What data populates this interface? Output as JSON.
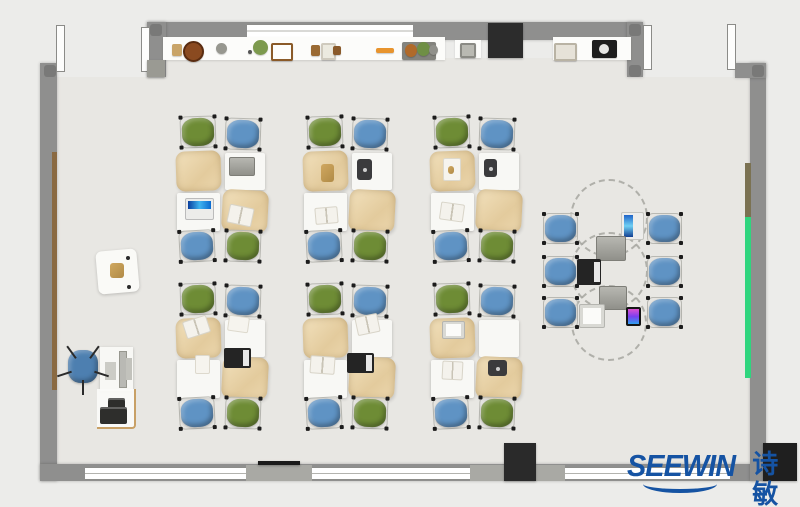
{
  "title": "classroom furniture floor plan",
  "logo": {
    "brand": "SEEWIN",
    "cjk": "诗敏",
    "color": "#1553a3"
  },
  "palette": {
    "outside": "#ececea",
    "floor": "#e8e7e3",
    "wall": "#8f8f8e",
    "wall_light": "#a9a9a4",
    "post": "#797978",
    "window": "#ffffff",
    "chair_green": "#6e8c35",
    "chair_blue": "#5f93c4",
    "chair_office": "#4d7fb0",
    "desk_white": "#f8f8f5",
    "accent_green": "#2fd57e",
    "accent_brown": "#8a6a42",
    "accent_olive": "#7b7252",
    "black": "#232323",
    "dash": "#9e9e98"
  },
  "scene": {
    "w": 800,
    "h": 507,
    "floor": [
      {
        "x": 57,
        "y": 77,
        "w": 693,
        "h": 388
      },
      {
        "x": 166,
        "y": 58,
        "w": 471,
        "h": 20
      }
    ],
    "walls": [
      {
        "x": 40,
        "y": 63,
        "w": 17,
        "h": 418,
        "n": "wall-left"
      },
      {
        "x": 40,
        "y": 464,
        "w": 727,
        "h": 17,
        "n": "wall-bottom"
      },
      {
        "x": 750,
        "y": 63,
        "w": 16,
        "h": 418,
        "n": "wall-right"
      },
      {
        "x": 735,
        "y": 63,
        "w": 31,
        "h": 15,
        "n": "wall-corner-top-right"
      },
      {
        "x": 147,
        "y": 22,
        "w": 496,
        "h": 18,
        "n": "wall-top"
      },
      {
        "x": 147,
        "y": 22,
        "w": 19,
        "h": 55,
        "n": "wall-stub-left"
      },
      {
        "x": 627,
        "y": 22,
        "w": 16,
        "h": 55,
        "n": "wall-stub-right"
      }
    ],
    "piers": [
      {
        "x": 246,
        "y": 465,
        "w": 66,
        "h": 16
      },
      {
        "x": 470,
        "y": 465,
        "w": 95,
        "h": 16
      }
    ],
    "windows": [
      {
        "x": 247,
        "y": 24,
        "w": 166,
        "h": 12
      },
      {
        "x": 85,
        "y": 467,
        "w": 161,
        "h": 11
      },
      {
        "x": 312,
        "y": 467,
        "w": 158,
        "h": 11
      },
      {
        "x": 565,
        "y": 467,
        "w": 165,
        "h": 11
      }
    ],
    "doors": [
      {
        "x": 56,
        "y": 25,
        "w": 7,
        "h": 45
      },
      {
        "x": 141,
        "y": 27,
        "w": 7,
        "h": 43
      },
      {
        "x": 643,
        "y": 25,
        "w": 7,
        "h": 43
      },
      {
        "x": 727,
        "y": 24,
        "w": 7,
        "h": 44
      }
    ],
    "posts": [
      {
        "x": 44,
        "y": 65
      },
      {
        "x": 150,
        "y": 65
      },
      {
        "x": 150,
        "y": 24
      },
      {
        "x": 629,
        "y": 24
      },
      {
        "x": 629,
        "y": 65
      },
      {
        "x": 752,
        "y": 65
      }
    ],
    "accents": [
      {
        "x": 52,
        "y": 152,
        "w": 5,
        "h": 238,
        "c": "#8a6a42",
        "n": "wall-rail-wood"
      },
      {
        "x": 745,
        "y": 163,
        "w": 6,
        "h": 54,
        "c": "#7b7252",
        "n": "wall-panel-olive"
      },
      {
        "x": 745,
        "y": 217,
        "w": 6,
        "h": 161,
        "c": "#2fd57e",
        "n": "wall-board-green"
      }
    ],
    "shelves": [
      {
        "x": 163,
        "y": 37,
        "w": 282,
        "h": 23
      },
      {
        "x": 455,
        "y": 40,
        "w": 26,
        "h": 18
      },
      {
        "x": 553,
        "y": 37,
        "w": 78,
        "h": 23
      }
    ],
    "blocks": [
      {
        "x": 488,
        "y": 23,
        "w": 35,
        "h": 35,
        "c": "#2c2c2c",
        "n": "cabinet"
      },
      {
        "x": 504,
        "y": 443,
        "w": 32,
        "h": 38,
        "c": "#2a2a2a",
        "n": "column"
      },
      {
        "x": 763,
        "y": 443,
        "w": 34,
        "h": 38,
        "c": "#1f1f1f",
        "n": "column"
      },
      {
        "x": 258,
        "y": 461,
        "w": 42,
        "h": 4,
        "c": "#1a1a1a",
        "n": "wall-board"
      },
      {
        "x": 147,
        "y": 60,
        "w": 18,
        "h": 17,
        "c": "#9a9a93",
        "n": "bin"
      }
    ],
    "shelf_items": [
      {
        "x": 172,
        "y": 44,
        "w": 10,
        "h": 12,
        "s": "rect",
        "c": "#c9a468",
        "n": "box"
      },
      {
        "x": 183,
        "y": 41,
        "w": 17,
        "h": 17,
        "s": "circle",
        "c": "#8a4a20",
        "b": "#5a2c10",
        "n": "pot"
      },
      {
        "x": 216,
        "y": 43,
        "w": 11,
        "h": 11,
        "s": "circle",
        "c": "#97978f",
        "n": "sphere"
      },
      {
        "x": 253,
        "y": 40,
        "w": 15,
        "h": 15,
        "s": "circle",
        "c": "#7d9a4e",
        "n": "plant"
      },
      {
        "x": 248,
        "y": 50,
        "w": 4,
        "h": 4,
        "s": "circle",
        "c": "#555555",
        "n": "dot"
      },
      {
        "x": 271,
        "y": 43,
        "w": 18,
        "h": 14,
        "s": "rect",
        "c": "#fdfdfb",
        "b": "#8a5a28",
        "n": "photo-frame"
      },
      {
        "x": 311,
        "y": 45,
        "w": 9,
        "h": 11,
        "s": "rect",
        "c": "#9a6a33",
        "n": "box"
      },
      {
        "x": 321,
        "y": 43,
        "w": 11,
        "h": 13,
        "s": "rect",
        "c": "#eceadf",
        "b": "#cfcabd",
        "n": "vase"
      },
      {
        "x": 333,
        "y": 46,
        "w": 8,
        "h": 9,
        "s": "rect",
        "c": "#8a5a2a",
        "n": "box"
      },
      {
        "x": 376,
        "y": 48,
        "w": 18,
        "h": 5,
        "s": "rect",
        "c": "#e8942d",
        "n": "pencil"
      },
      {
        "x": 402,
        "y": 42,
        "w": 34,
        "h": 18,
        "s": "rect",
        "c": "#83837d",
        "n": "tray"
      },
      {
        "x": 405,
        "y": 44,
        "w": 12,
        "h": 13,
        "s": "circle",
        "c": "#b06a2a",
        "n": "pot"
      },
      {
        "x": 417,
        "y": 42,
        "w": 13,
        "h": 14,
        "s": "circle",
        "c": "#6f8f45",
        "n": "plant"
      },
      {
        "x": 429,
        "y": 45,
        "w": 9,
        "h": 10,
        "s": "circle",
        "c": "#90908a",
        "n": "pot"
      },
      {
        "x": 460,
        "y": 43,
        "w": 12,
        "h": 11,
        "s": "rect",
        "c": "#b9b9b2",
        "b": "#8a8a84",
        "n": "box"
      },
      {
        "x": 554,
        "y": 43,
        "w": 19,
        "h": 14,
        "s": "rect",
        "c": "#e6e2d8",
        "b": "#b9b3a4",
        "n": "photo-frame"
      },
      {
        "x": 592,
        "y": 40,
        "w": 25,
        "h": 18,
        "s": "rect",
        "c": "#1e1e1e",
        "n": "speaker"
      },
      {
        "x": 599,
        "y": 44,
        "w": 10,
        "h": 10,
        "s": "circle",
        "c": "#e6e6e4",
        "n": "speaker-cone"
      }
    ],
    "clusters": {
      "origins": [
        {
          "x": 176,
          "y": 116
        },
        {
          "x": 303,
          "y": 116
        },
        {
          "x": 430,
          "y": 116
        },
        {
          "x": 176,
          "y": 283
        },
        {
          "x": 303,
          "y": 283
        },
        {
          "x": 430,
          "y": 283
        }
      ],
      "chair_w": 36,
      "chair_h": 32,
      "chairs": [
        {
          "dx": 4,
          "dy": 0,
          "color": "green",
          "rot": -2
        },
        {
          "dx": 49,
          "dy": 2,
          "color": "blue",
          "rot": 2
        },
        {
          "dx": 3,
          "dy": 114,
          "color": "blue",
          "rot": -3
        },
        {
          "dx": 49,
          "dy": 114,
          "color": "green",
          "rot": 2
        }
      ],
      "desks": [
        {
          "dx": 0,
          "dy": 35,
          "w": 45,
          "h": 40,
          "type": "tan",
          "rot": -2
        },
        {
          "dx": 49,
          "dy": 37,
          "w": 40,
          "h": 37,
          "type": "white",
          "rot": 0
        },
        {
          "dx": 1,
          "dy": 77,
          "w": 43,
          "h": 38,
          "type": "white",
          "rot": 0
        },
        {
          "dx": 46,
          "dy": 74,
          "w": 46,
          "h": 42,
          "type": "tan",
          "rot": 3
        }
      ]
    },
    "desk_items": [
      {
        "t": "laptop_gray",
        "x": 229,
        "y": 157,
        "w": 24,
        "h": 17
      },
      {
        "t": "laptop_blue",
        "x": 185,
        "y": 198,
        "w": 27,
        "h": 20
      },
      {
        "t": "book_open",
        "x": 228,
        "y": 206,
        "w": 23,
        "h": 17,
        "rot": 12
      },
      {
        "t": "pouch",
        "x": 321,
        "y": 164,
        "w": 13,
        "h": 18
      },
      {
        "t": "tablet_dark",
        "x": 357,
        "y": 159,
        "w": 15,
        "h": 21
      },
      {
        "t": "book_open",
        "x": 315,
        "y": 207,
        "w": 21,
        "h": 15,
        "rot": -5
      },
      {
        "t": "paper",
        "x": 443,
        "y": 158,
        "w": 16,
        "h": 21
      },
      {
        "t": "pouch",
        "x": 448,
        "y": 166,
        "w": 6,
        "h": 8
      },
      {
        "t": "tablet_dark",
        "x": 484,
        "y": 159,
        "w": 13,
        "h": 18
      },
      {
        "t": "book_open",
        "x": 440,
        "y": 203,
        "w": 22,
        "h": 16,
        "rot": 8
      },
      {
        "t": "book_open",
        "x": 184,
        "y": 318,
        "w": 23,
        "h": 16,
        "rot": -18
      },
      {
        "t": "paper",
        "x": 228,
        "y": 316,
        "w": 19,
        "h": 14,
        "rot": 8
      },
      {
        "t": "paper",
        "x": 195,
        "y": 355,
        "w": 13,
        "h": 17
      },
      {
        "t": "laptop_black",
        "x": 224,
        "y": 348,
        "w": 27,
        "h": 20
      },
      {
        "t": "book_open",
        "x": 356,
        "y": 315,
        "w": 21,
        "h": 17,
        "rot": -12
      },
      {
        "t": "book_open",
        "x": 310,
        "y": 356,
        "w": 23,
        "h": 16,
        "rot": 4
      },
      {
        "t": "laptop_black",
        "x": 347,
        "y": 353,
        "w": 27,
        "h": 20
      },
      {
        "t": "laptop_white",
        "x": 442,
        "y": 321,
        "w": 21,
        "h": 16
      },
      {
        "t": "book_open",
        "x": 442,
        "y": 361,
        "w": 19,
        "h": 17,
        "rot": 3
      },
      {
        "t": "tablet_dark",
        "x": 488,
        "y": 360,
        "w": 19,
        "h": 16
      }
    ],
    "collab": {
      "circles": [
        {
          "cx": 607,
          "cy": 216,
          "r": 37
        },
        {
          "cx": 607,
          "cy": 269,
          "r": 37
        },
        {
          "cx": 607,
          "cy": 321,
          "r": 36
        }
      ],
      "chair_w": 35,
      "chair_h": 31,
      "chairs": [
        {
          "x": 543,
          "y": 213
        },
        {
          "x": 543,
          "y": 256
        },
        {
          "x": 543,
          "y": 297
        },
        {
          "x": 647,
          "y": 213
        },
        {
          "x": 647,
          "y": 256
        },
        {
          "x": 647,
          "y": 297
        }
      ],
      "devices": [
        {
          "t": "tablet_blue",
          "x": 621,
          "y": 212,
          "w": 21,
          "h": 26
        },
        {
          "t": "laptop_gray",
          "x": 596,
          "y": 236,
          "w": 28,
          "h": 23
        },
        {
          "t": "laptop_black",
          "x": 577,
          "y": 259,
          "w": 24,
          "h": 26
        },
        {
          "t": "laptop_gray",
          "x": 599,
          "y": 286,
          "w": 26,
          "h": 22
        },
        {
          "t": "laptop_white",
          "x": 579,
          "y": 304,
          "w": 24,
          "h": 22
        },
        {
          "t": "phone_color",
          "x": 626,
          "y": 307,
          "w": 15,
          "h": 19
        }
      ]
    },
    "teacher": {
      "side_table": {
        "x": 97,
        "y": 250,
        "w": 41,
        "h": 43,
        "rot": -5
      },
      "side_item": {
        "t": "pouch",
        "x": 110,
        "y": 263,
        "w": 14,
        "h": 15
      },
      "dots": [
        {
          "x": 126,
          "y": 256
        },
        {
          "x": 127,
          "y": 285
        }
      ],
      "desk": {
        "x": 100,
        "y": 347,
        "w": 33,
        "h": 44
      },
      "monitor": {
        "x": 119,
        "y": 351,
        "w": 6,
        "h": 35
      },
      "keyboard": {
        "x": 105,
        "y": 362,
        "w": 11,
        "h": 18
      },
      "pc": {
        "x": 126,
        "y": 358,
        "w": 6,
        "h": 22
      },
      "chair": {
        "x": 66,
        "y": 348,
        "w": 34,
        "h": 37
      },
      "printer_table": {
        "x": 97,
        "y": 389,
        "w": 37,
        "h": 38
      },
      "printer": [
        {
          "x": 108,
          "y": 398,
          "w": 17,
          "h": 12
        },
        {
          "x": 100,
          "y": 407,
          "w": 27,
          "h": 17
        }
      ]
    }
  }
}
